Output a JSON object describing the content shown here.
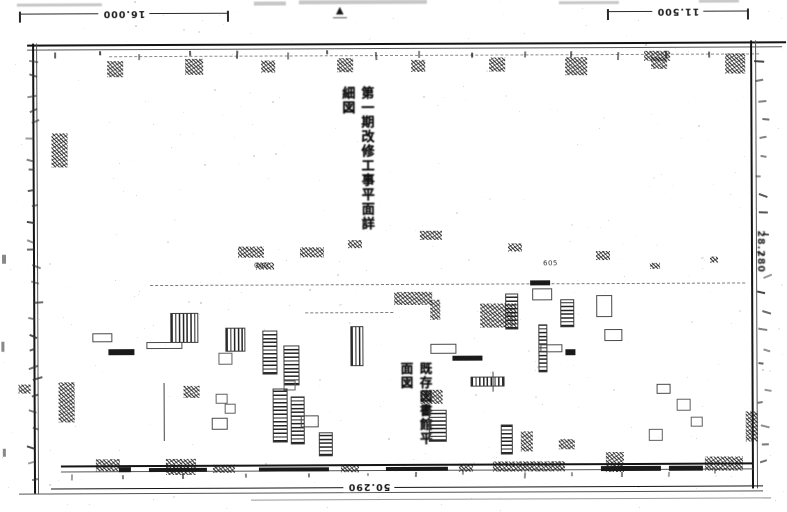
{
  "document": {
    "kind": "scanned architectural floor plan",
    "marker_triangle": "▲"
  },
  "colors": {
    "paper": "#ffffff",
    "ink": "#161616",
    "faint_ink": "#888888"
  },
  "dimensions": {
    "top_left": "16.000",
    "top_right": "11.500",
    "bottom": "50.290",
    "right": "28.280"
  },
  "vertical_text": {
    "title": "第一期改修工事平面詳細図",
    "note": "既存図書館平面図"
  },
  "small_labels": [
    {
      "text": "605",
      "x": 543,
      "y": 260
    },
    {
      "text": "000",
      "x": 254,
      "y": 261
    }
  ],
  "plan_marks": [
    [
      150,
      284,
      595,
      1,
      "hline"
    ],
    [
      305,
      312,
      88,
      1,
      "hline"
    ],
    [
      238,
      246,
      26,
      11,
      "blob"
    ],
    [
      300,
      247,
      24,
      10,
      "blob"
    ],
    [
      256,
      262,
      18,
      7,
      "blob"
    ],
    [
      420,
      231,
      22,
      9,
      "blob"
    ],
    [
      348,
      240,
      14,
      8,
      "blob"
    ],
    [
      508,
      244,
      14,
      8,
      "blob"
    ],
    [
      596,
      252,
      14,
      9,
      "blob"
    ],
    [
      650,
      264,
      10,
      6,
      "blob"
    ],
    [
      710,
      258,
      8,
      6,
      "blob"
    ],
    [
      170,
      312,
      26,
      28,
      "hatchv"
    ],
    [
      225,
      327,
      18,
      22,
      "hatchv"
    ],
    [
      262,
      330,
      13,
      42,
      "hatchh"
    ],
    [
      283,
      345,
      14,
      38,
      "hatchh"
    ],
    [
      350,
      326,
      11,
      38,
      "hatchv"
    ],
    [
      394,
      292,
      38,
      13,
      "blob"
    ],
    [
      430,
      300,
      10,
      20,
      "blob"
    ],
    [
      530,
      281,
      20,
      5,
      "bar"
    ],
    [
      532,
      289,
      18,
      10,
      "rect"
    ],
    [
      505,
      294,
      11,
      34,
      "hatchh"
    ],
    [
      480,
      304,
      36,
      24,
      "blob"
    ],
    [
      538,
      325,
      7,
      46,
      "hatchh"
    ],
    [
      430,
      344,
      24,
      8,
      "rect"
    ],
    [
      452,
      356,
      30,
      5,
      "bar"
    ],
    [
      470,
      377,
      32,
      8,
      "hatchv"
    ],
    [
      560,
      300,
      12,
      26,
      "hatchh"
    ],
    [
      596,
      296,
      14,
      20,
      "rect"
    ],
    [
      604,
      330,
      16,
      10,
      "rect"
    ],
    [
      92,
      332,
      18,
      7,
      "rect"
    ],
    [
      108,
      348,
      26,
      6,
      "bar"
    ],
    [
      146,
      341,
      34,
      5,
      "rect"
    ],
    [
      218,
      352,
      12,
      10,
      "sq"
    ],
    [
      283,
      380,
      10,
      8,
      "sq"
    ],
    [
      52,
      132,
      16,
      34,
      "blob"
    ],
    [
      272,
      388,
      13,
      52,
      "hatchh"
    ],
    [
      290,
      396,
      12,
      46,
      "hatchh"
    ],
    [
      163,
      382,
      2,
      58,
      "vline"
    ],
    [
      183,
      385,
      16,
      12,
      "blob"
    ],
    [
      215,
      393,
      10,
      8,
      "sq"
    ],
    [
      224,
      403,
      9,
      8,
      "sq"
    ],
    [
      211,
      417,
      14,
      10,
      "rect"
    ],
    [
      58,
      381,
      16,
      40,
      "blob"
    ],
    [
      18,
      383,
      12,
      9,
      "blob"
    ],
    [
      95,
      458,
      24,
      12,
      "blob"
    ],
    [
      165,
      458,
      30,
      16,
      "blob"
    ],
    [
      420,
      390,
      22,
      14,
      "blob"
    ],
    [
      428,
      410,
      16,
      30,
      "hatchh"
    ],
    [
      300,
      415,
      16,
      10,
      "rect"
    ],
    [
      318,
      432,
      12,
      22,
      "hatchh"
    ],
    [
      500,
      425,
      10,
      28,
      "hatchh"
    ],
    [
      520,
      432,
      12,
      20,
      "blob"
    ],
    [
      558,
      440,
      16,
      10,
      "blob"
    ],
    [
      605,
      453,
      18,
      20,
      "blob"
    ],
    [
      648,
      430,
      12,
      10,
      "sq"
    ],
    [
      676,
      400,
      12,
      10,
      "sq"
    ],
    [
      690,
      418,
      10,
      8,
      "sq"
    ],
    [
      656,
      385,
      12,
      8,
      "rect"
    ],
    [
      745,
      413,
      12,
      30,
      "blob"
    ],
    [
      492,
      372,
      3,
      20,
      "vline"
    ],
    [
      540,
      345,
      20,
      6,
      "rect"
    ],
    [
      565,
      350,
      10,
      6,
      "bar"
    ],
    [
      118,
      466,
      12,
      5,
      "bar"
    ],
    [
      148,
      467,
      58,
      4,
      "bar"
    ],
    [
      212,
      464,
      22,
      8,
      "blob"
    ],
    [
      258,
      467,
      70,
      4,
      "bar"
    ],
    [
      340,
      464,
      18,
      8,
      "blob"
    ],
    [
      385,
      467,
      62,
      4,
      "bar"
    ],
    [
      458,
      464,
      14,
      8,
      "blob"
    ],
    [
      492,
      462,
      72,
      10,
      "blob"
    ],
    [
      600,
      467,
      60,
      5,
      "bar"
    ],
    [
      668,
      467,
      34,
      5,
      "bar"
    ],
    [
      704,
      458,
      38,
      14,
      "blob"
    ],
    [
      108,
      60,
      16,
      16,
      "blob"
    ],
    [
      186,
      58,
      18,
      16,
      "blob"
    ],
    [
      262,
      60,
      14,
      12,
      "blob"
    ],
    [
      338,
      58,
      16,
      14,
      "blob"
    ],
    [
      412,
      60,
      14,
      12,
      "blob"
    ],
    [
      490,
      58,
      16,
      14,
      "blob"
    ],
    [
      566,
      58,
      22,
      18,
      "blob"
    ],
    [
      645,
      52,
      26,
      10,
      "blob"
    ],
    [
      652,
      58,
      16,
      12,
      "blob"
    ],
    [
      726,
      55,
      20,
      20,
      "blob"
    ],
    [
      2,
      253,
      4,
      9,
      "edge"
    ],
    [
      1,
      340,
      3,
      10,
      "edge"
    ],
    [
      2,
      447,
      3,
      8,
      "edge"
    ],
    [
      18,
      2,
      85,
      3,
      "smudge"
    ],
    [
      255,
      1,
      32,
      4,
      "smudge"
    ],
    [
      300,
      0,
      128,
      4,
      "smudge"
    ],
    [
      560,
      2,
      60,
      3,
      "smudge"
    ],
    [
      700,
      1,
      40,
      3,
      "smudge"
    ]
  ]
}
